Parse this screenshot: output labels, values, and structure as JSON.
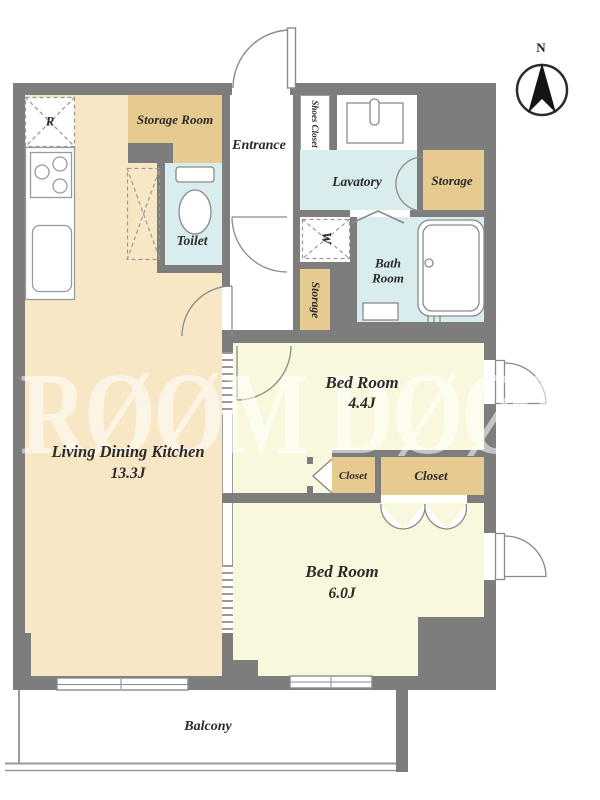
{
  "colors": {
    "wall": "#7d7d7d",
    "ldk_floor": "#f8e7c5",
    "bedroom_floor": "#f9f8dc",
    "wet_floor": "#d9ecee",
    "storage_fill": "#e6ca90",
    "label_text": "#2a2a2a"
  },
  "labels": {
    "storage_room": "Storage Room",
    "entrance": "Entrance",
    "shoes_closet": "Shoes Closet",
    "lavatory": "Lavatory",
    "storage_upper": "Storage",
    "toilet": "Toilet",
    "washer": "W",
    "bath_room": "Bath Room",
    "storage_corridor": "Storage",
    "bedroom1_name": "Bed Room",
    "bedroom1_size": "4.4J",
    "ldk_name": "Living Dining Kitchen",
    "ldk_size": "13.3J",
    "closet_left": "Closet",
    "closet_right": "Closet",
    "bedroom2_name": "Bed Room",
    "bedroom2_size": "6.0J",
    "balcony": "Balcony",
    "refrigerator": "R",
    "compass_north": "N",
    "watermark": "RØØM DØØR"
  }
}
